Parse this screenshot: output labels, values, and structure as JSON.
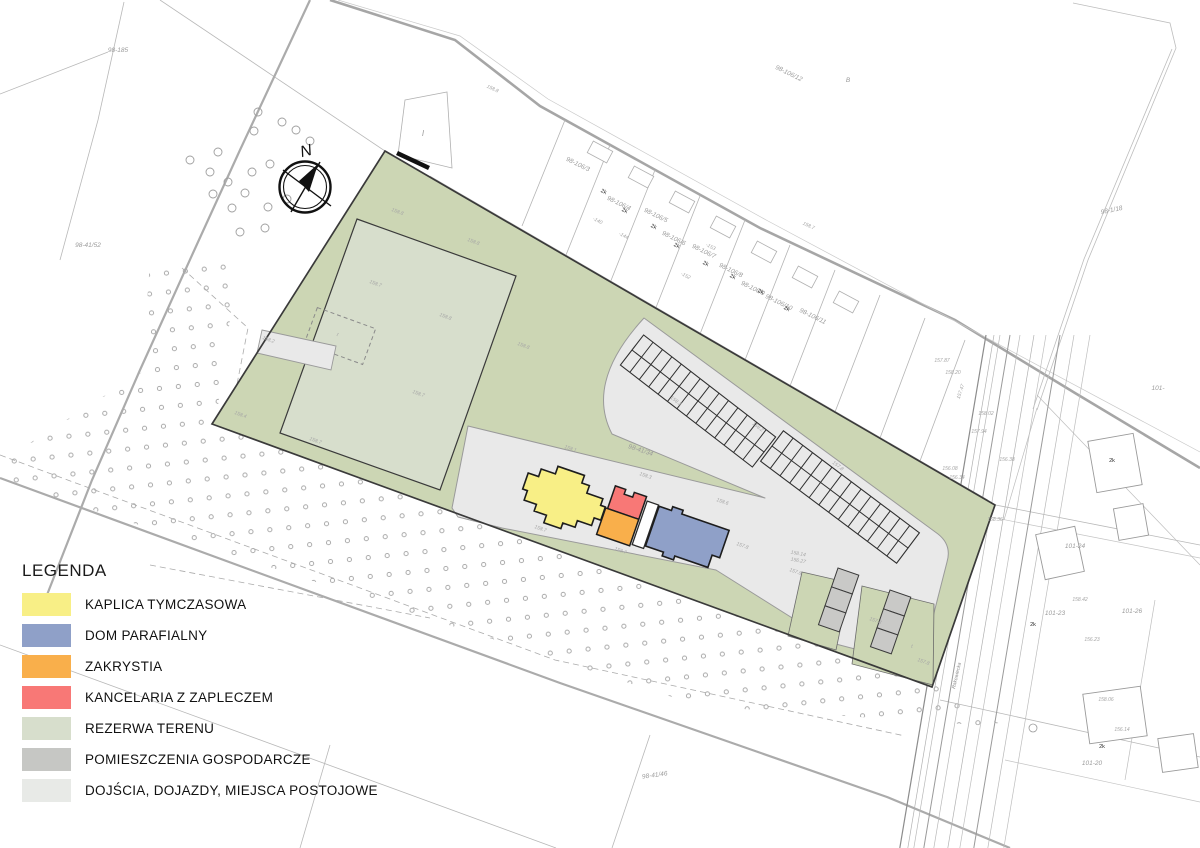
{
  "legend": {
    "title": "LEGENDA",
    "items": [
      {
        "name": "kaplica",
        "label": "KAPLICA TYMCZASOWA",
        "color": "#F8EF86"
      },
      {
        "name": "dom",
        "label": "DOM PARAFIALNY",
        "color": "#8FA0C8"
      },
      {
        "name": "zakrystia",
        "label": "ZAKRYSTIA",
        "color": "#F9AF4B"
      },
      {
        "name": "kancelaria",
        "label": "KANCELARIA Z ZAPLECZEM",
        "color": "#F87876"
      },
      {
        "name": "rezerwa",
        "label": "REZERWA TERENU",
        "color": "#D7DECC"
      },
      {
        "name": "gospodarcze",
        "label": "POMIESZCZENIA GOSPODARCZE",
        "color": "#C6C7C4"
      },
      {
        "name": "dojscia",
        "label": "DOJŚCIA, DOJAZDY, MIEJSCA POSTOJOWE",
        "color": "#E8EAE7"
      }
    ]
  },
  "compass": {
    "label": "N"
  },
  "colors": {
    "site_green": "#CCD6B4",
    "driveway": "#E9E9E9",
    "rezerwa": "#D7DECC",
    "kaplica": "#F8EF86",
    "dom": "#8FA0C8",
    "zakrystia": "#F9AF4B",
    "kancelaria": "#F87876",
    "gospodarcze": "#C9C9C7",
    "outline": "#3A3A3A"
  },
  "map": {
    "parcel_labels": [
      {
        "x": 118,
        "y": 52,
        "r": 0,
        "t": "98-185"
      },
      {
        "x": 88,
        "y": 247,
        "r": 0,
        "t": "98-41/52"
      },
      {
        "x": 640,
        "y": 452,
        "r": 18,
        "t": "98-41/34"
      },
      {
        "x": 655,
        "y": 777,
        "r": -8,
        "t": "98-41/46"
      },
      {
        "x": 1112,
        "y": 212,
        "r": -12,
        "t": "98-1/18"
      },
      {
        "x": 577,
        "y": 166,
        "r": 26,
        "t": "98-106/3"
      },
      {
        "x": 618,
        "y": 205,
        "r": 26,
        "t": "98-106/4"
      },
      {
        "x": 655,
        "y": 217,
        "r": 26,
        "t": "98-106/5"
      },
      {
        "x": 673,
        "y": 240,
        "r": 26,
        "t": "98-106/6"
      },
      {
        "x": 703,
        "y": 253,
        "r": 26,
        "t": "98-106/7"
      },
      {
        "x": 730,
        "y": 272,
        "r": 26,
        "t": "98-106/8"
      },
      {
        "x": 752,
        "y": 290,
        "r": 26,
        "t": "98-106/9"
      },
      {
        "x": 778,
        "y": 304,
        "r": 26,
        "t": "98-106/10"
      },
      {
        "x": 812,
        "y": 318,
        "r": 26,
        "t": "98-106/11"
      },
      {
        "x": 788,
        "y": 75,
        "r": 26,
        "t": "98-106/12"
      },
      {
        "x": 1075,
        "y": 548,
        "r": 0,
        "t": "101-24"
      },
      {
        "x": 1055,
        "y": 615,
        "r": 0,
        "t": "101-23"
      },
      {
        "x": 1132,
        "y": 613,
        "r": 0,
        "t": "101-26"
      },
      {
        "x": 1092,
        "y": 765,
        "r": 0,
        "t": "101-20"
      },
      {
        "x": 1158,
        "y": 390,
        "r": 0,
        "t": "101-"
      },
      {
        "x": 848,
        "y": 82,
        "r": 0,
        "t": "B"
      }
    ],
    "building_markers": [
      {
        "x": 603,
        "y": 193,
        "r": 26,
        "t": "2k"
      },
      {
        "x": 624,
        "y": 212,
        "r": 26,
        "t": "2k"
      },
      {
        "x": 653,
        "y": 228,
        "r": 26,
        "t": "2k"
      },
      {
        "x": 676,
        "y": 247,
        "r": 26,
        "t": "2k"
      },
      {
        "x": 705,
        "y": 265,
        "r": 26,
        "t": "2k"
      },
      {
        "x": 732,
        "y": 278,
        "r": 26,
        "t": "2k"
      },
      {
        "x": 760,
        "y": 293,
        "r": 26,
        "t": "2k"
      },
      {
        "x": 786,
        "y": 310,
        "r": 26,
        "t": "2k"
      },
      {
        "x": 1112,
        "y": 462,
        "r": 0,
        "t": "2k"
      },
      {
        "x": 1033,
        "y": 626,
        "r": 0,
        "t": "2k"
      },
      {
        "x": 1102,
        "y": 748,
        "r": 0,
        "t": "2k"
      }
    ],
    "elevation_labels": [
      {
        "x": 397,
        "y": 213,
        "r": 20,
        "t": "158.8"
      },
      {
        "x": 473,
        "y": 243,
        "r": 20,
        "t": "158.8"
      },
      {
        "x": 375,
        "y": 285,
        "r": 20,
        "t": "158.7"
      },
      {
        "x": 445,
        "y": 318,
        "r": 20,
        "t": "158.8"
      },
      {
        "x": 523,
        "y": 347,
        "r": 20,
        "t": "158.8"
      },
      {
        "x": 418,
        "y": 395,
        "r": 20,
        "t": "158.7"
      },
      {
        "x": 315,
        "y": 442,
        "r": 20,
        "t": "158.7"
      },
      {
        "x": 240,
        "y": 416,
        "r": 20,
        "t": "158.4"
      },
      {
        "x": 268,
        "y": 341,
        "r": 20,
        "t": "158.2"
      },
      {
        "x": 492,
        "y": 90,
        "r": 25,
        "t": "158.8"
      },
      {
        "x": 808,
        "y": 227,
        "r": 25,
        "t": "158.7"
      },
      {
        "x": 645,
        "y": 477,
        "r": 19,
        "t": "158.3"
      },
      {
        "x": 570,
        "y": 450,
        "r": 19,
        "t": "158.1"
      },
      {
        "x": 620,
        "y": 552,
        "r": 19,
        "t": "158.7"
      },
      {
        "x": 540,
        "y": 530,
        "r": 19,
        "t": "158.7"
      },
      {
        "x": 722,
        "y": 503,
        "r": 19,
        "t": "158.6"
      },
      {
        "x": 742,
        "y": 547,
        "r": 19,
        "t": "157.8"
      },
      {
        "x": 795,
        "y": 573,
        "r": 19,
        "t": "157.8"
      },
      {
        "x": 875,
        "y": 622,
        "r": 19,
        "t": "157.8"
      },
      {
        "x": 923,
        "y": 663,
        "r": 19,
        "t": "157.8"
      },
      {
        "x": 675,
        "y": 402,
        "r": 37,
        "t": "158.3"
      },
      {
        "x": 757,
        "y": 428,
        "r": 37,
        "t": "158.2"
      },
      {
        "x": 837,
        "y": 467,
        "r": 37,
        "t": "157.8"
      },
      {
        "x": 798,
        "y": 555,
        "r": 10,
        "t": "158.14"
      },
      {
        "x": 798,
        "y": 562,
        "r": 10,
        "t": "156.27"
      },
      {
        "x": 912,
        "y": 648,
        "r": 0,
        "t": "t"
      },
      {
        "x": 337,
        "y": 336,
        "r": 20,
        "t": "t"
      },
      {
        "x": 942,
        "y": 362,
        "r": 0,
        "t": "157.87"
      },
      {
        "x": 953,
        "y": 374,
        "r": 0,
        "t": "158.20"
      },
      {
        "x": 962,
        "y": 392,
        "r": -72,
        "t": "157.47"
      },
      {
        "x": 986,
        "y": 415,
        "r": 0,
        "t": "158.02"
      },
      {
        "x": 979,
        "y": 433,
        "r": 0,
        "t": "157.94"
      },
      {
        "x": 1007,
        "y": 461,
        "r": 0,
        "t": "156.38"
      },
      {
        "x": 950,
        "y": 470,
        "r": 0,
        "t": "156.08"
      },
      {
        "x": 957,
        "y": 479,
        "r": 0,
        "t": "156.34"
      },
      {
        "x": 995,
        "y": 521,
        "r": 0,
        "t": "158.36"
      },
      {
        "x": 1080,
        "y": 601,
        "r": 0,
        "t": "158.42"
      },
      {
        "x": 1092,
        "y": 641,
        "r": 0,
        "t": "156.23"
      },
      {
        "x": 1106,
        "y": 701,
        "r": 0,
        "t": "158.06"
      },
      {
        "x": 1122,
        "y": 731,
        "r": 0,
        "t": "156.14"
      },
      {
        "x": 597,
        "y": 222,
        "r": 27,
        "t": "-140"
      },
      {
        "x": 623,
        "y": 237,
        "r": 27,
        "t": "-144"
      },
      {
        "x": 685,
        "y": 277,
        "r": 27,
        "t": "-152"
      },
      {
        "x": 710,
        "y": 248,
        "r": 27,
        "t": "-153"
      }
    ],
    "street_label": {
      "x": 958,
      "y": 676,
      "r": -77,
      "t": "Rakowiecka"
    },
    "area_label_I": {
      "x": 423,
      "y": 136,
      "t": "I"
    }
  }
}
